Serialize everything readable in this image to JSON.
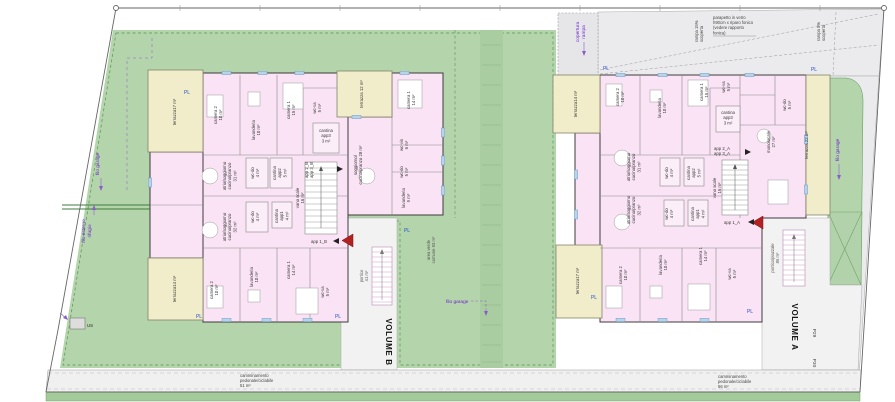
{
  "colors": {
    "lawn": "#b4d4ac",
    "lawn_hatch": "#a9cda1",
    "building_pink": "#f9e3f5",
    "terrace_yellow": "#f1ecca",
    "hardscape_gray": "#ededef",
    "annotation_purple": "#6d23cf",
    "annotation_blue": "#2953c4",
    "entrance_red": "#b22222"
  },
  "site": {
    "pl": "PL",
    "us": "US",
    "p29": "P29",
    "p30": "P30",
    "filo_garage": "filo garage",
    "filo_esterno": [
      "filo esterno",
      "rifugio"
    ],
    "copertura": [
      "copertura",
      "rampa"
    ],
    "parapetto": [
      "parapetto in vetro",
      "h90cm x riparo fonico",
      "(vedere rapporto",
      "fonica)"
    ],
    "rampa15": [
      "rampa 15%",
      "scoperta"
    ],
    "rampa5": [
      "rampa 5%",
      "scoperta"
    ],
    "camm_sx": [
      "camminamento",
      "pedonale/ciclabile",
      "51 m²"
    ],
    "camm_dx": [
      "camminamento",
      "pedonale/ciclabile",
      "56 m²"
    ],
    "area_verde": [
      "area verde",
      "comune 93 m²"
    ]
  },
  "b": {
    "volume": "VOLUME B",
    "rooms": {
      "ter_tl": [
        "terrazza17 m²"
      ],
      "cam2_t": [
        "camera 2",
        "10 m²"
      ],
      "lav_t": [
        "lavanderia",
        "10 m²"
      ],
      "cam1_t": [
        "camera 1",
        "15 m²"
      ],
      "wcva_t": [
        "wc-va",
        "5 m²"
      ],
      "ter12": [
        "terrazza 12 m²"
      ],
      "cam1_w": [
        "camera 1",
        "14 m²"
      ],
      "sogg28": [
        "soggiorno/",
        "cucina/pranzo 28 m²"
      ],
      "wcvis": [
        "wc-vis",
        "6 m²"
      ],
      "wcdo5": [
        "wc-do",
        "5 m²"
      ],
      "lav9": [
        "lavanderia",
        "9 m²"
      ],
      "cant3": [
        "cantina",
        "app3",
        "3 m²"
      ],
      "app23": [
        "app 2_B",
        "app 3_B"
      ],
      "wcdo4_t": [
        "wc-do",
        "4 m²"
      ],
      "cant2": [
        "cantina",
        "app2",
        "5 m²"
      ],
      "atrio31": [
        "atrio/soggiorno",
        "cucina/pranzo",
        "31 m²"
      ],
      "vano": [
        "vano scale",
        "16 m²"
      ],
      "cant1": [
        "cantina",
        "app1",
        "4 m²"
      ],
      "atrio32": [
        "atrio/soggiorno",
        "cucina/pranzo",
        "32 m²"
      ],
      "wcdo4_b": [
        "wc-do",
        "4 m²"
      ],
      "app1": [
        "app 1_B"
      ],
      "ter_bl": [
        "terrazza14 m²"
      ],
      "cam2_b": [
        "camera 2",
        "10 m²"
      ],
      "lav_b": [
        "lavanderia",
        "10 m²"
      ],
      "cam1_b": [
        "camera 1",
        "14 m²"
      ],
      "wcva_b": [
        "wc-va",
        "5 m²"
      ],
      "portico": [
        "portico",
        "41 m²"
      ]
    }
  },
  "a": {
    "volume": "VOLUME A",
    "rooms": {
      "ter_tl": [
        "terrazza14 m²"
      ],
      "cam2_t": [
        "camera 2",
        "10 m²"
      ],
      "lav_t": [
        "lavanderia",
        "10 m²"
      ],
      "cam1_t": [
        "camera 1",
        "15 m²"
      ],
      "wcva_t": [
        "wc-va",
        "5 m²"
      ],
      "cant3": [
        "cantina",
        "app3",
        "3 m²"
      ],
      "wcdo5": [
        "wc-do",
        "5 m²"
      ],
      "mono": [
        "monolocale",
        "27 m²"
      ],
      "ter22": [
        "terrazza 22 m²"
      ],
      "app23": [
        "app 2_A",
        "app 3_A"
      ],
      "atrio31": [
        "atrio/soggiorno",
        "cucina/pranzo",
        "31 m²"
      ],
      "wcdo4_t": [
        "wc-do",
        "4 m²"
      ],
      "cant2": [
        "cantina",
        "app2",
        "5 m²"
      ],
      "vano": [
        "vano scale",
        "16 m²"
      ],
      "cant1": [
        "cantina",
        "app1",
        "4 m²"
      ],
      "atrio32": [
        "atrio/soggiorno",
        "cucina/pranzo",
        "32 m²"
      ],
      "wcdo4_b": [
        "wc-do",
        "4 m²"
      ],
      "app1": [
        "app 1_A"
      ],
      "ter_bl": [
        "terrazza17 m²"
      ],
      "cam2_b": [
        "camera 2",
        "10 m²"
      ],
      "lav_b": [
        "lavanderia",
        "10 m²"
      ],
      "cam1_b": [
        "camera 1",
        "14 m²"
      ],
      "wcva_b": [
        "wc-va",
        "5 m²"
      ],
      "portico_piazzale": [
        "portico/piazzale",
        "85 m²"
      ]
    }
  }
}
